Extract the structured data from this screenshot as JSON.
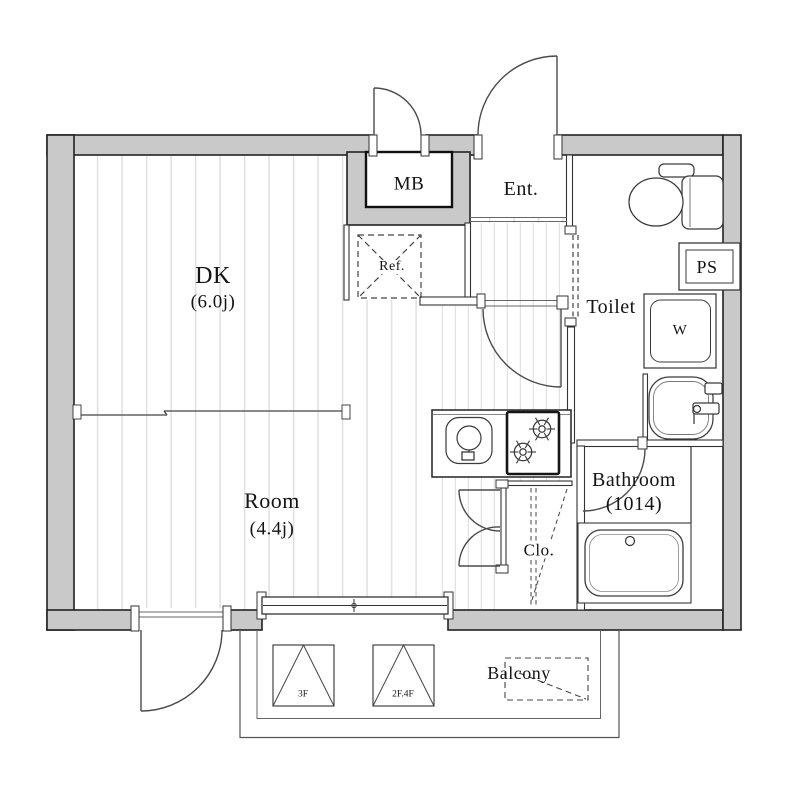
{
  "floorplan": {
    "rooms": {
      "dk": {
        "label": "DK",
        "size": "(6.0j)"
      },
      "room": {
        "label": "Room",
        "size": "(4.4j)"
      },
      "entrance": {
        "label": "Ent."
      },
      "meter_box": {
        "label": "MB"
      },
      "toilet": {
        "label": "Toilet"
      },
      "pipe_shaft": {
        "label": "PS"
      },
      "washer_pan": {
        "label": "W"
      },
      "bathroom": {
        "label": "Bathroom",
        "size": "(1014)"
      },
      "closet": {
        "label": "Clo."
      },
      "refrigerator_space": {
        "label": "Ref."
      },
      "balcony": {
        "label": "Balcony"
      }
    },
    "markers": {
      "stair_marker_left": "3F",
      "stair_marker_right": "2F.4F"
    },
    "fixtures": [
      "toilet-icon",
      "toilet-tank",
      "washbasin-icon",
      "washer-pan-box",
      "bathtub-icon",
      "kitchen-sink-icon",
      "stove-burners-icon",
      "refrigerator-dashed-box",
      "closet-hanger-dashes",
      "window-sliding",
      "door-swing-arcs",
      "balcony-outline",
      "stair-hatch-squares"
    ],
    "colors": {
      "wall_fill": "#c9c9c9",
      "outline": "#222222",
      "thin_line": "#444444",
      "floor_stripe": "#e0e0e0",
      "background": "#ffffff"
    }
  }
}
